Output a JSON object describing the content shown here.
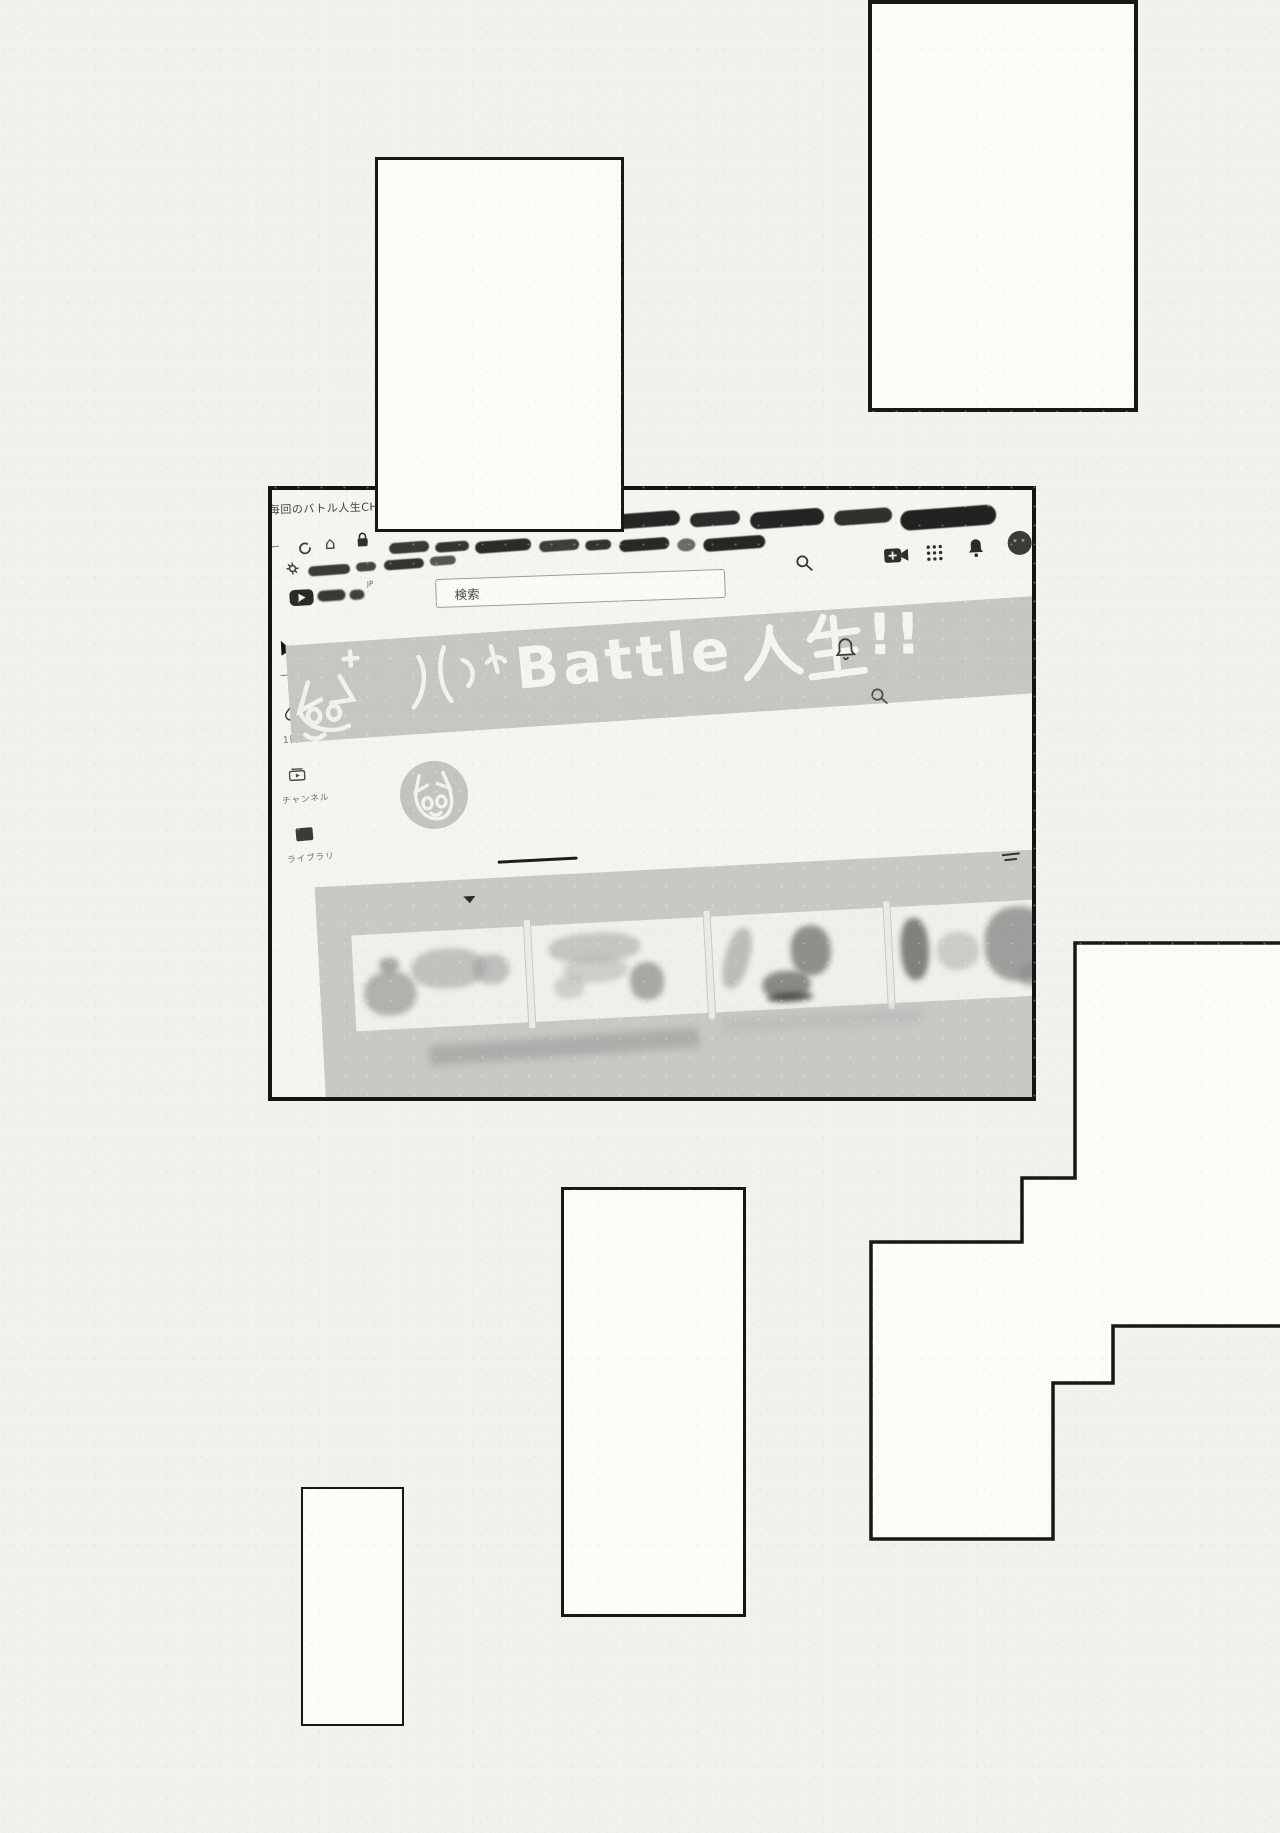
{
  "paper": {
    "background": "#f3f1ec",
    "ink": "#171717",
    "banner_grey": "#c7c6c2"
  },
  "browser": {
    "tab_title": "毎回のバトル人生CH - Yo",
    "logo_superscript": "JP",
    "search_placeholder": "検索"
  },
  "channel": {
    "banner_title": "Battle人生!!",
    "banner_title_latin": "Battle",
    "banner_title_kanji": "人生",
    "banner_title_suffix": "!!",
    "sidebar_items": [
      {
        "label": "ーム"
      },
      {
        "label": "1円"
      },
      {
        "label": "チャンネル"
      },
      {
        "label": "ライブラリ"
      }
    ]
  }
}
